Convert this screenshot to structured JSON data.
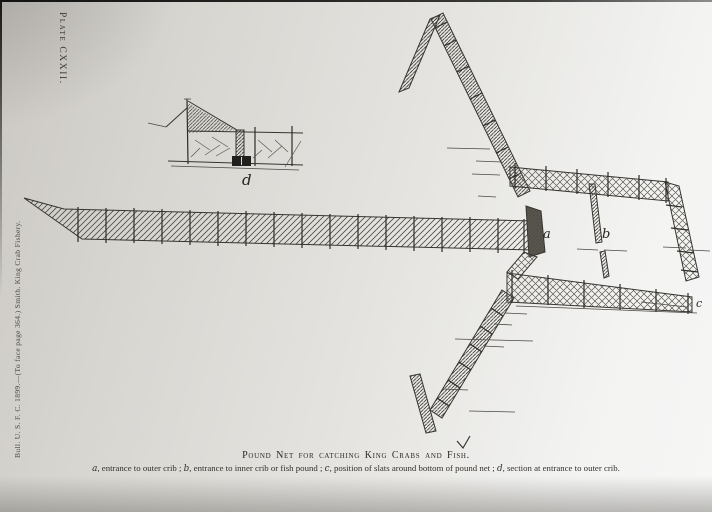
{
  "page": {
    "plate_label": "Plate CXXII.",
    "spine_text": "Bull. U. S. F. C. 1899.—(To face page 364.)   Smith.   King Crab Fishery.",
    "caption": "Pound Net for catching King Crabs and Fish."
  },
  "legend": {
    "a_term": "a",
    "a_desc": ", entrance to outer crib ; ",
    "b_term": "b",
    "b_desc": ", entrance to inner crib or fish pound ; ",
    "c_term": "c",
    "c_desc": ", position of slats around bottom of pound net ; ",
    "d_term": "d",
    "d_desc": ", section at entrance to outer crib."
  },
  "figure": {
    "label_a": "a",
    "label_b": "b",
    "label_c": "c",
    "label_d": "d"
  },
  "colors": {
    "paper": "#e2e0dc",
    "ink": "#33312c"
  }
}
